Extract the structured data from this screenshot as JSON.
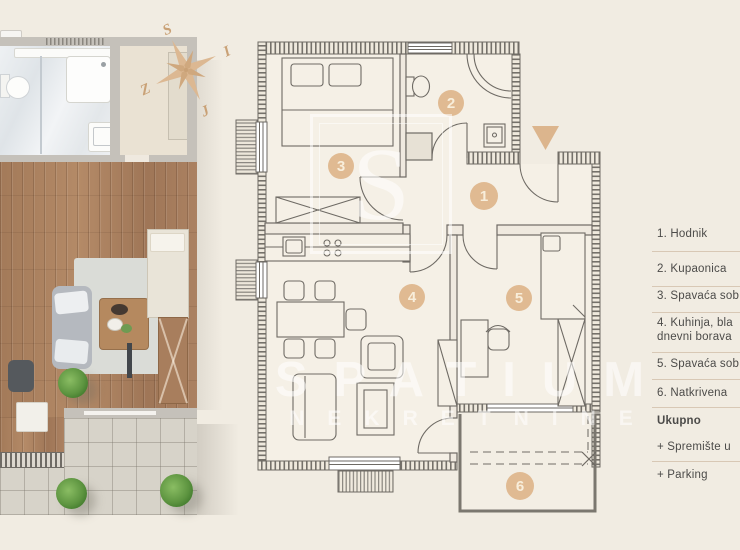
{
  "compass": {
    "north": "S",
    "east": "I",
    "south": "J",
    "west": "Z"
  },
  "watermark": {
    "logo_letter": "S",
    "title": "SPATIUM",
    "subtitle": "NEKRETNINE"
  },
  "plan": {
    "rooms": [
      {
        "number": "1"
      },
      {
        "number": "2"
      },
      {
        "number": "3"
      },
      {
        "number": "4"
      },
      {
        "number": "5"
      },
      {
        "number": "6"
      }
    ]
  },
  "legend": {
    "items": [
      {
        "lines": [
          "1. Hodnik"
        ]
      },
      {
        "lines": [
          "2. Kupaonica"
        ]
      },
      {
        "lines": [
          "3. Spavaća sob"
        ]
      },
      {
        "lines": [
          "4. Kuhinja, bla",
          "dnevni borava"
        ]
      },
      {
        "lines": [
          "5. Spavaća sob"
        ]
      },
      {
        "lines": [
          "6. Natkrivena"
        ]
      }
    ],
    "total_label": "Ukupno",
    "extras": [
      {
        "label": "+ Spremište u"
      },
      {
        "label": "+ Parking"
      }
    ]
  },
  "colors": {
    "background": "#f1ece2",
    "accent_tan": "#dfb992",
    "plan_line": "#6e6a64",
    "legend_text": "#4c4b49",
    "divider": "#d8c8b5"
  }
}
